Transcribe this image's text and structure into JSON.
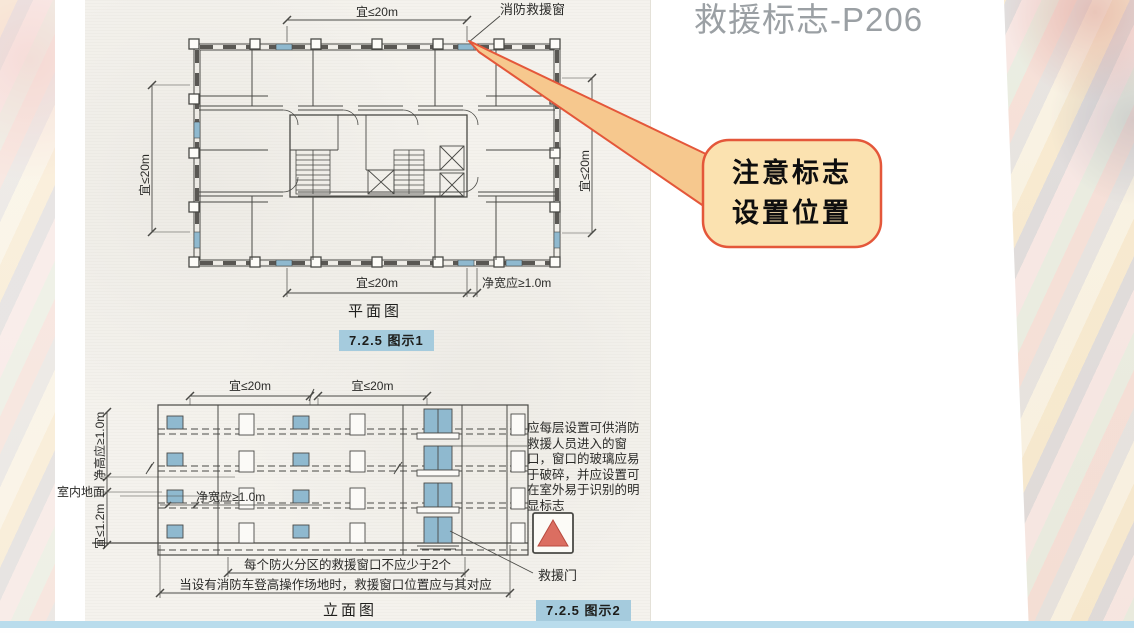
{
  "slide": {
    "title": "救援标志-P206"
  },
  "callout": {
    "line1": "注意标志",
    "line2": "设置位置"
  },
  "plan": {
    "dim_top": "宜≤20m",
    "window_label": "消防救援窗",
    "dim_left": "宜≤20m",
    "dim_right": "宜≤20m",
    "dim_bottom": "宜≤20m",
    "dim_clear_width": "净宽应≥1.0m",
    "caption": "平面图",
    "badge": "7.2.5 图示1"
  },
  "elevation": {
    "dim_top_left": "宜≤20m",
    "dim_top_right": "宜≤20m",
    "dim_clear_height": "净高应≥1.0m",
    "dim_sill_height": "宜≤1.2m",
    "indoor_floor_label": "室内地面",
    "dim_clear_width": "净宽应≥1.0m",
    "note": "应每层设置可供消防救援人员进入的窗口，窗口的玻璃应易于破碎，并应设置可在室外易于识别的明显标志",
    "door_label": "救援门",
    "rule_compartment": "每个防火分区的救援窗口不应少于2个",
    "rule_ladder": "当设有消防车登高操作场地时，救援窗口位置应与其对应",
    "caption": "立面图",
    "badge": "7.2.5 图示2"
  },
  "colors": {
    "accent_border": "#e4573a",
    "callout_fill": "#fbe2b0",
    "callout_tail_fill": "#f6c88e",
    "badge_bg": "#a5cbdd",
    "rescue_window_blue": "#8fb9cf",
    "sign_triangle": "#db6e61",
    "bottom_bar": "#b9dcec",
    "title_gray": "#9ba0a4"
  }
}
